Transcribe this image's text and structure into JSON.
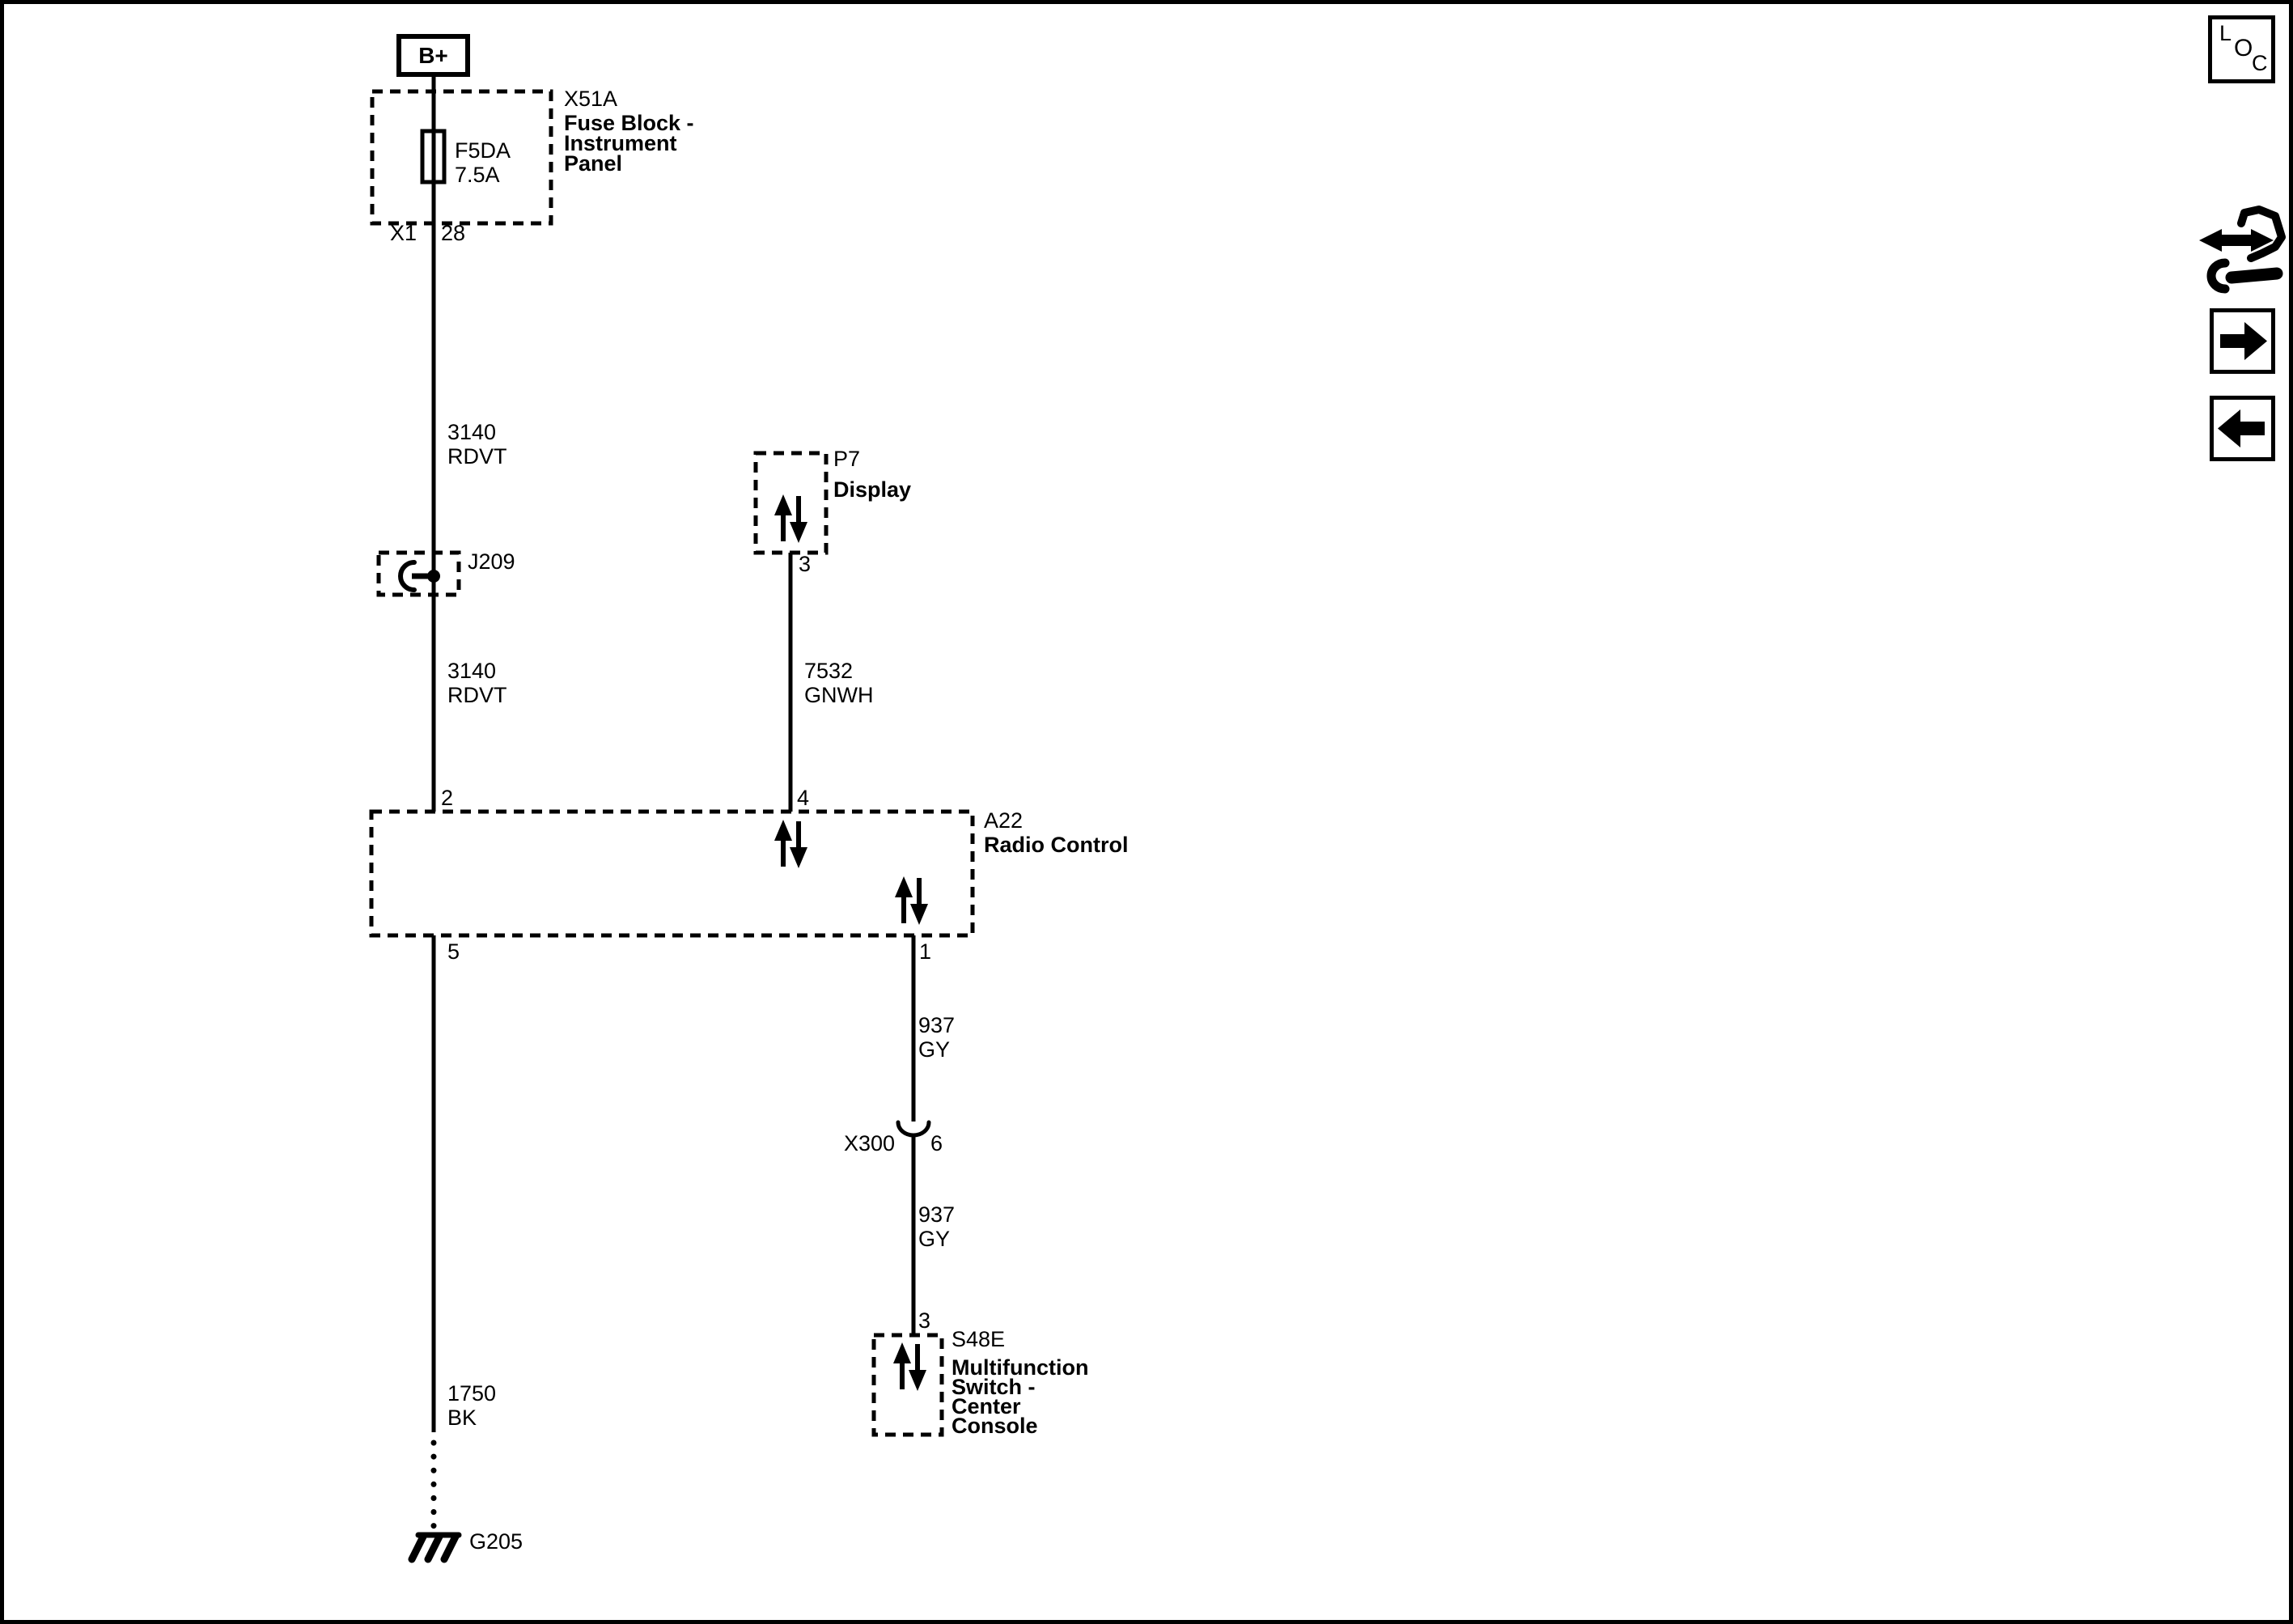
{
  "colors": {
    "ink": "#000000",
    "paper": "#ffffff"
  },
  "corner_badge": {
    "letters": [
      "L",
      "O",
      "C"
    ]
  },
  "nav": {
    "repair_icon": "wrench-double-arrow",
    "forward_icon": "right-arrow",
    "back_icon": "left-arrow"
  },
  "components": {
    "battery_feed": {
      "label": "B+"
    },
    "fuse_block": {
      "id": "X51A",
      "name": [
        "Fuse Block -",
        "Instrument",
        "Panel"
      ],
      "fuse_id": "F5DA",
      "fuse_rating": "7.5A",
      "connector_id": "X1",
      "pin_out": "28"
    },
    "splice": {
      "id": "J209"
    },
    "display": {
      "id": "P7",
      "name": "Display",
      "pin": "3"
    },
    "radio_control": {
      "id": "A22",
      "name": "Radio Control",
      "pin_top_left": "2",
      "pin_top_right": "4",
      "pin_bottom_left": "5",
      "pin_bottom_right": "1"
    },
    "inline_connector": {
      "id": "X300",
      "pin": "6"
    },
    "multifunction_switch": {
      "id": "S48E",
      "name": [
        "Multifunction",
        "Switch -",
        "Center",
        "Console"
      ],
      "pin": "3"
    },
    "ground": {
      "id": "G205"
    }
  },
  "wires": {
    "batt_to_splice": {
      "circuit": "3140",
      "color": "RDVT"
    },
    "splice_to_radio": {
      "circuit": "3140",
      "color": "RDVT"
    },
    "display_to_radio": {
      "circuit": "7532",
      "color": "GNWH"
    },
    "radio_to_x300": {
      "circuit": "937",
      "color": "GY"
    },
    "x300_to_switch": {
      "circuit": "937",
      "color": "GY"
    },
    "radio_to_ground": {
      "circuit": "1750",
      "color": "BK"
    }
  }
}
